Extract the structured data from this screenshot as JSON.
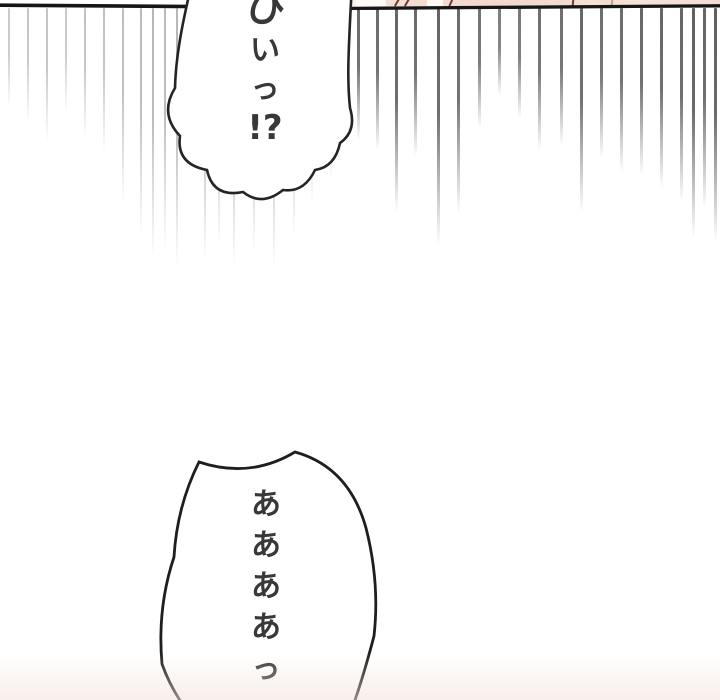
{
  "page": {
    "width": 720,
    "height": 700,
    "background": "#ffffff"
  },
  "panel_border": {
    "color": "#161616",
    "left_segment": {
      "x1": 0,
      "y1": 5.2,
      "x2": 197,
      "y2": 6.6,
      "width": 3.6
    },
    "right_segment": {
      "x1": 350,
      "y1": 8.4,
      "x2": 720,
      "y2": 5.8,
      "width": 3.3
    }
  },
  "prev_panel_sliver": {
    "skin_color": "#f3d8cc",
    "strip": {
      "x": 338,
      "w": 382,
      "h": 6
    },
    "marks": [
      {
        "x": 396,
        "rot": 30
      },
      {
        "x": 406,
        "rot": 30
      },
      {
        "x": 450,
        "rot": 24
      },
      {
        "x": 572,
        "rot": 6
      },
      {
        "x": 611,
        "rot": 6,
        "light": true
      }
    ],
    "highlights": [
      {
        "x": 356,
        "w": 30
      },
      {
        "x": 427,
        "w": 16
      }
    ]
  },
  "speed_lines": {
    "top": 8,
    "color": "#4a4a4a",
    "items": [
      {
        "x": 8,
        "end": 108,
        "o": 0.3,
        "w": 2
      },
      {
        "x": 27,
        "end": 122,
        "o": 0.32,
        "w": 2
      },
      {
        "x": 46,
        "end": 142,
        "o": 0.33,
        "w": 2
      },
      {
        "x": 65,
        "end": 112,
        "o": 0.3,
        "w": 2
      },
      {
        "x": 84,
        "end": 138,
        "o": 0.34,
        "w": 2
      },
      {
        "x": 103,
        "end": 152,
        "o": 0.34,
        "w": 2
      },
      {
        "x": 122,
        "end": 205,
        "o": 0.36,
        "w": 2
      },
      {
        "x": 140,
        "end": 235,
        "o": 0.38,
        "w": 2
      },
      {
        "x": 152,
        "end": 258,
        "o": 0.4,
        "w": 2
      },
      {
        "x": 164,
        "end": 250,
        "o": 0.38,
        "w": 2
      },
      {
        "x": 176,
        "end": 268,
        "o": 0.4,
        "w": 2
      },
      {
        "x": 204,
        "end": 262,
        "o": 0.42,
        "w": 2
      },
      {
        "x": 218,
        "end": 246,
        "o": 0.42,
        "w": 2
      },
      {
        "x": 233,
        "end": 266,
        "o": 0.42,
        "w": 2
      },
      {
        "x": 253,
        "end": 254,
        "o": 0.42,
        "w": 2
      },
      {
        "x": 273,
        "end": 268,
        "o": 0.42,
        "w": 2
      },
      {
        "x": 293,
        "end": 238,
        "o": 0.4,
        "w": 2
      },
      {
        "x": 311,
        "end": 205,
        "o": 0.38,
        "w": 2
      },
      {
        "x": 330,
        "end": 182,
        "o": 0.36,
        "w": 2
      },
      {
        "x": 357,
        "end": 140,
        "o": 0.82,
        "w": 2.5
      },
      {
        "x": 376,
        "end": 150,
        "o": 0.82,
        "w": 2.5
      },
      {
        "x": 395,
        "end": 212,
        "o": 0.85,
        "w": 2.5
      },
      {
        "x": 414,
        "end": 156,
        "o": 0.82,
        "w": 2.5
      },
      {
        "x": 437,
        "end": 245,
        "o": 0.85,
        "w": 2.5
      },
      {
        "x": 457,
        "end": 214,
        "o": 0.82,
        "w": 2.5
      },
      {
        "x": 478,
        "end": 128,
        "o": 0.78,
        "w": 2.5
      },
      {
        "x": 498,
        "end": 95,
        "o": 0.72,
        "w": 2.5
      },
      {
        "x": 518,
        "end": 118,
        "o": 0.75,
        "w": 2.5
      },
      {
        "x": 538,
        "end": 150,
        "o": 0.8,
        "w": 2.5
      },
      {
        "x": 560,
        "end": 145,
        "o": 0.8,
        "w": 2.5
      },
      {
        "x": 580,
        "end": 212,
        "o": 0.84,
        "w": 2.5
      },
      {
        "x": 600,
        "end": 158,
        "o": 0.8,
        "w": 2.5
      },
      {
        "x": 620,
        "end": 172,
        "o": 0.82,
        "w": 2.5
      },
      {
        "x": 640,
        "end": 175,
        "o": 0.84,
        "w": 2.5
      },
      {
        "x": 660,
        "end": 188,
        "o": 0.85,
        "w": 2.5
      },
      {
        "x": 680,
        "end": 202,
        "o": 0.85,
        "w": 2.5
      },
      {
        "x": 692,
        "end": 238,
        "o": 0.88,
        "w": 2.5
      },
      {
        "x": 703,
        "end": 208,
        "o": 0.85,
        "w": 2.5
      },
      {
        "x": 714,
        "end": 242,
        "o": 0.88,
        "w": 3
      }
    ]
  },
  "bubbles": {
    "top": {
      "style": "scalloped-shock",
      "fill": "#ffffff",
      "outline": "#242424",
      "text": "ひいっ!?",
      "chars": [
        {
          "c": "ひ",
          "size": 40,
          "mt": -4
        },
        {
          "c": "い",
          "size": 30
        },
        {
          "c": "っ",
          "size": 29
        },
        {
          "c": "!?",
          "size": 34,
          "bold": true
        }
      ]
    },
    "bottom": {
      "style": "spiky-scream",
      "fill": "#ffffff",
      "outline": "#1e1e1e",
      "text": "ああああっ…",
      "chars": [
        {
          "c": "あ",
          "size": 30
        },
        {
          "c": "あ",
          "size": 30
        },
        {
          "c": "あ",
          "size": 30
        },
        {
          "c": "あ",
          "size": 30
        },
        {
          "c": "っ",
          "size": 29
        },
        {
          "c": "…",
          "size": 26,
          "mt": 2
        }
      ]
    }
  },
  "bottom_tint": {
    "color": "#f3e2d9"
  }
}
